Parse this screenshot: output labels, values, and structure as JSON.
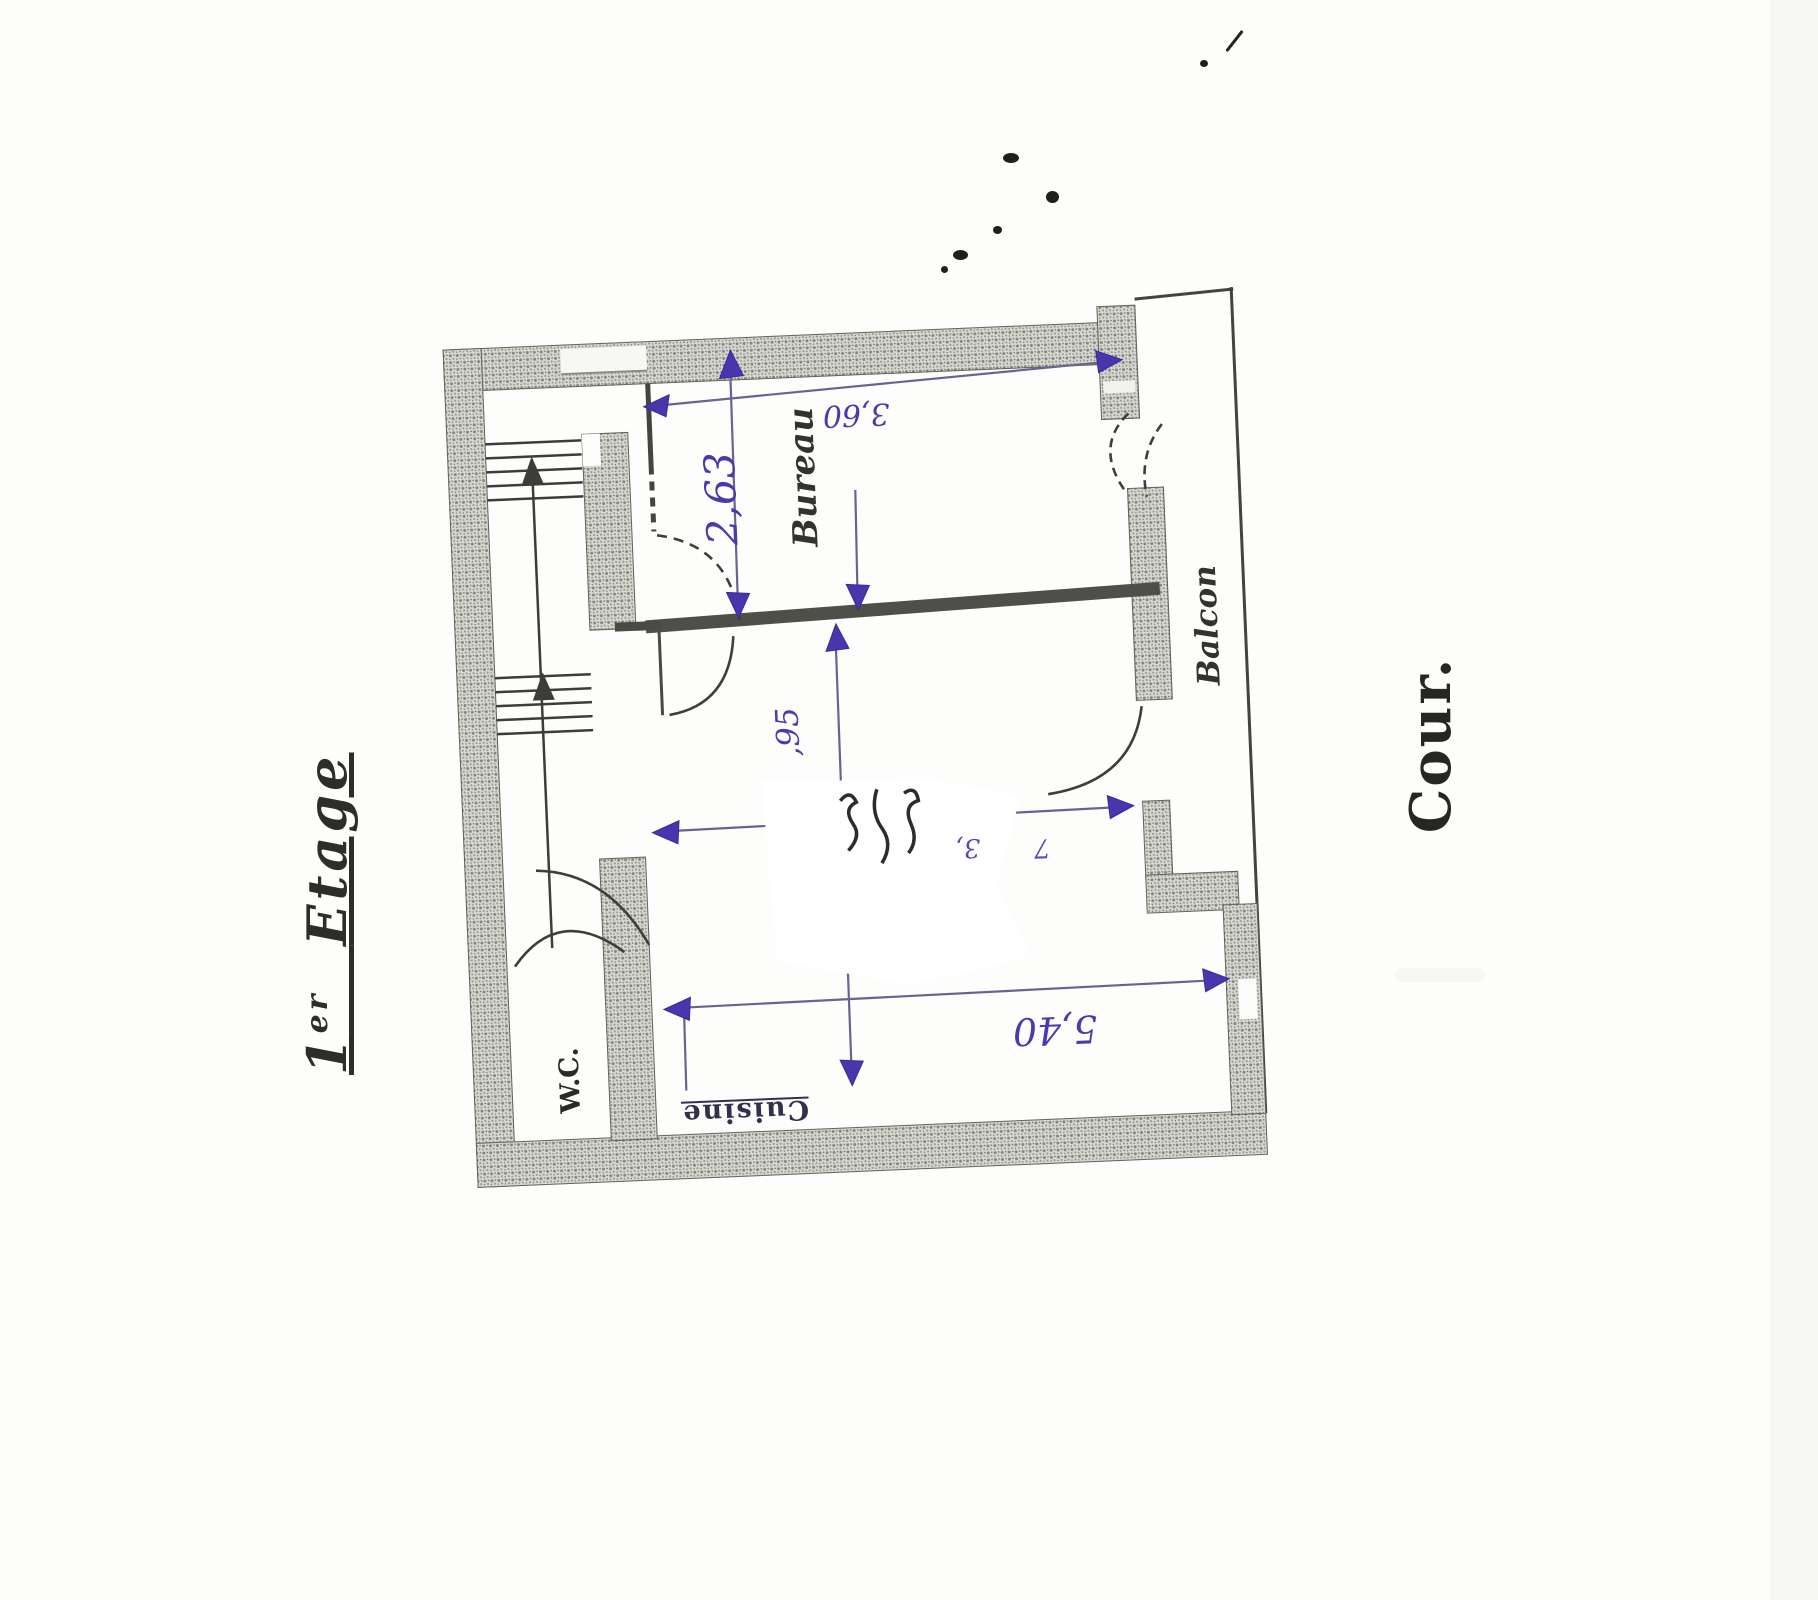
{
  "theme": {
    "ink": "#4836ac",
    "pencil": "#3f3f3a",
    "wall_fill": "#d8d8d2"
  },
  "scan": {
    "floor_label": {
      "number": "1",
      "ordinal": "er",
      "word": "Etage"
    },
    "court_label": "Cour.",
    "rooms": {
      "bureau": "Bureau",
      "balcon": "Balcon",
      "wc": "W.C.",
      "cuisine": "Cuisine"
    },
    "dimensions": {
      "bureau_width": "3,60",
      "bureau_depth": "2,63",
      "hall_depth": ",95",
      "living_width": "5,40",
      "erased_fragment_left": "3,",
      "erased_fragment_right": "7"
    }
  }
}
